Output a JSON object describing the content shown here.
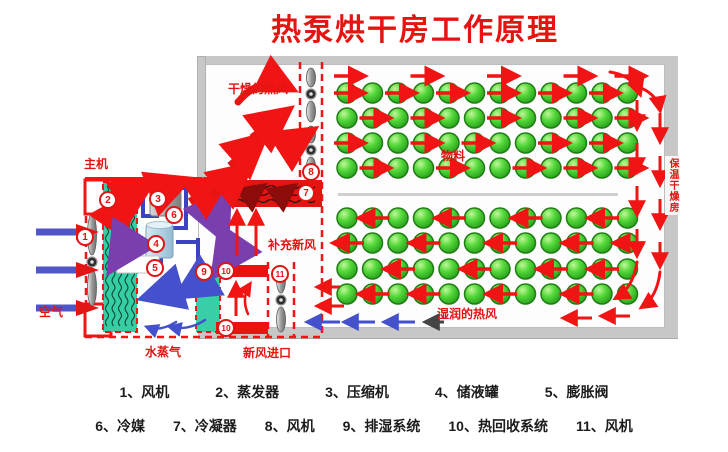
{
  "title": "热泵烘干房工作原理",
  "labels": {
    "host": "主机",
    "air": "空气",
    "dry_hot_air": "干燥的热风",
    "makeup_fresh_air": "补充新风",
    "fresh_air_inlet": "新风进口",
    "water_vapor": "水蒸气",
    "material": "物料",
    "moist_hot_air": "湿润的热风",
    "insulated_drying_room": "保温干燥房"
  },
  "badges": [
    "1",
    "2",
    "3",
    "4",
    "5",
    "6",
    "7",
    "8",
    "9",
    "10",
    "10",
    "11"
  ],
  "legend": {
    "separator": "、",
    "row1": [
      {
        "num": "1",
        "name": "风机"
      },
      {
        "num": "2",
        "name": "蒸发器"
      },
      {
        "num": "3",
        "name": "压缩机"
      },
      {
        "num": "4",
        "name": "储液罐"
      },
      {
        "num": "5",
        "name": "膨胀阀"
      }
    ],
    "row2": [
      {
        "num": "6",
        "name": "冷媒"
      },
      {
        "num": "7",
        "name": "冷凝器"
      },
      {
        "num": "8",
        "name": "风机"
      },
      {
        "num": "9",
        "name": "排湿系统"
      },
      {
        "num": "10",
        "name": "热回收系统"
      },
      {
        "num": "11",
        "name": "风机"
      }
    ]
  },
  "material_grid": {
    "groups": [
      {
        "position": "top",
        "rows": 4,
        "cols": 12,
        "airflow": "right"
      },
      {
        "position": "bottom",
        "rows": 4,
        "cols": 12,
        "airflow": "left"
      }
    ]
  },
  "colors": {
    "title_red": "#e41410",
    "diagram_red": "#f01414",
    "dark_red": "#8c0c0c",
    "wall_gray": "#c7c7c7",
    "material_green": "#3ecb2e",
    "evaporator_teal": "#35cda4",
    "pipe_blue": "#3b43c4",
    "arrow_purple": "#7a3fae",
    "arrow_blue": "#4450cc",
    "tank_blue": "#aacfdf",
    "compressor_gray": "#9c9c9c"
  }
}
